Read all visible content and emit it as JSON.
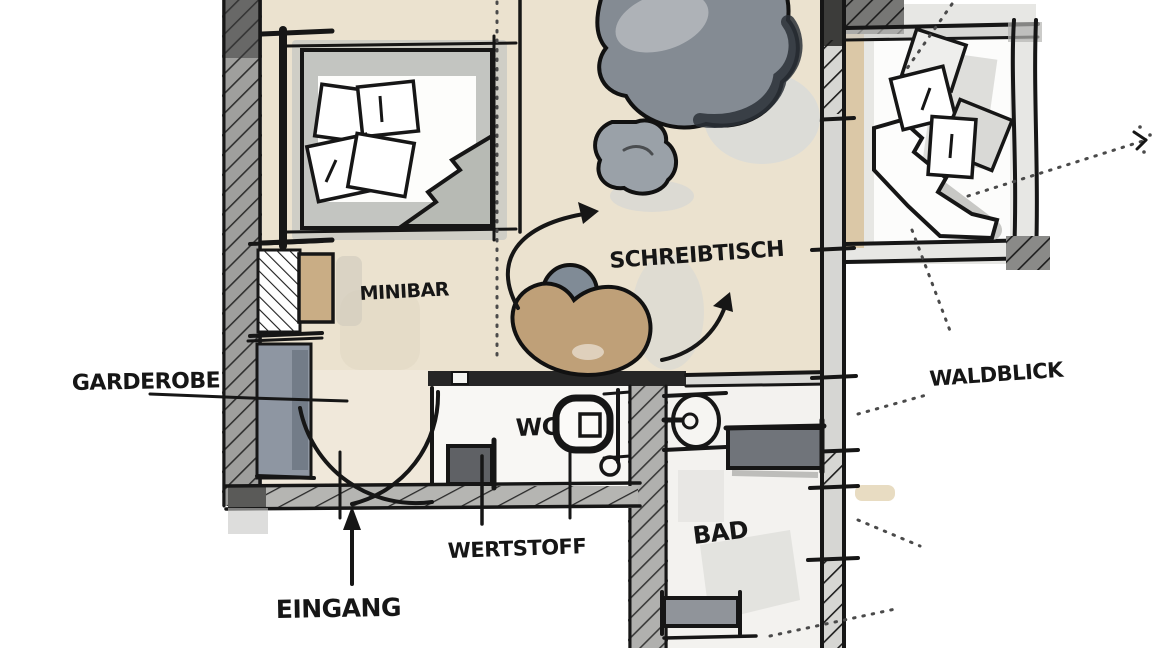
{
  "scene": {
    "kind": "hand-drawn hotel-room floor plan sketch",
    "language": "de"
  },
  "labels": {
    "minibar": "MINIBAR",
    "desk": "SCHREIBTISCH",
    "wardrobe": "GARDEROBE",
    "wc": "WC",
    "bath": "BAD",
    "recycling": "WERTSTOFF",
    "entrance": "EINGANG",
    "forest_view": "WALDBLICK"
  },
  "colors": {
    "paper": "#ffffff",
    "ink": "#161616",
    "floor_main": "#ebe2cf",
    "floor_entry": "#f0e8da",
    "floor_bath": "#f3f2ef",
    "floor_right_room": "#e7e7e4",
    "wall_fill": "#a6a6a4",
    "desk_tan": "#bfa078",
    "minibar_tan": "#c9ad85",
    "wardrobe_gray": "#8e96a2",
    "beanbag_gray": "#848b93",
    "counter_gray": "#70747a"
  }
}
